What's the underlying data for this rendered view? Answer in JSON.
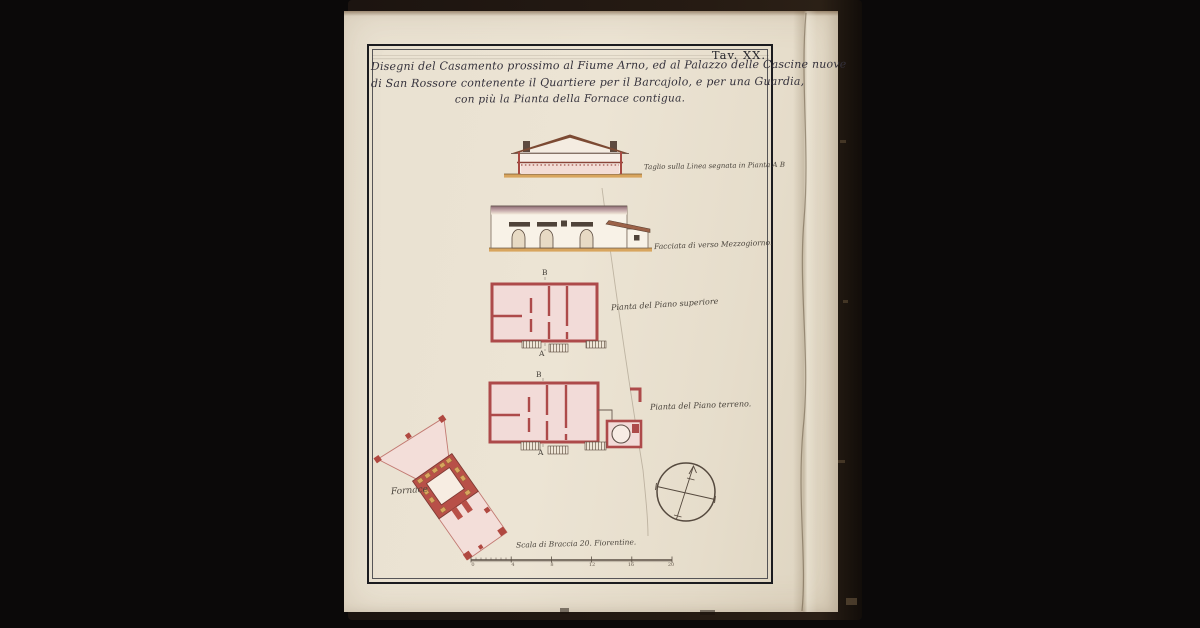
{
  "palette": {
    "paper": "#e9e1d1",
    "cover": "#241a13",
    "ink": "#33303a",
    "plan_wall_red": "#ad4a4a",
    "plan_wash_pink": "#f2dbd8",
    "ground_ochre": "#d8a55e",
    "roof_brown": "#7c4a33"
  },
  "plate": {
    "label": "Tav. XX.",
    "title_lines": [
      "Disegni del Casamento prossimo al Fiume Arno, ed al Palazzo delle Cascine nuove",
      "di San Rossore contenente il Quartiere per il Barcajolo, e per una Guardia,",
      "con più la Pianta della Fornace contigua."
    ],
    "captions": {
      "section": "Taglio sulla Linea segnata in Pianta A B",
      "facade": "Facciata di verso Mezzogiorno.",
      "upper_plan": "Pianta del Piano superiore",
      "ground_plan": "Pianta del Piano terreno.",
      "fornace": "Fornace",
      "scale": "Scala di Braccia 20. Fiorentine."
    },
    "markers": {
      "top": "B",
      "bottom": "A"
    },
    "scale_bar": {
      "ticks": [
        "0",
        "4",
        "8",
        "12",
        "16",
        "20"
      ]
    }
  }
}
